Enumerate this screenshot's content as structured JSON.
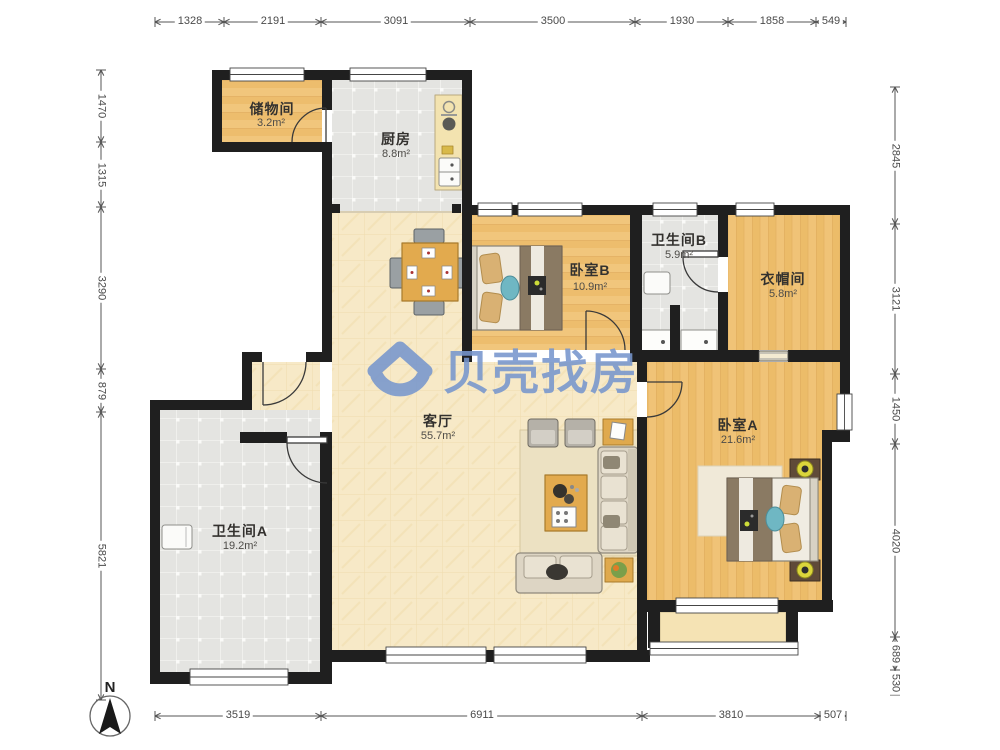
{
  "watermark": {
    "brand": "贝壳找房"
  },
  "compass": {
    "north": "N"
  },
  "rooms": {
    "storage": {
      "name": "储物间",
      "area": "3.2m²"
    },
    "kitchen": {
      "name": "厨房",
      "area": "8.8m²"
    },
    "bedroomB": {
      "name": "卧室B",
      "area": "10.9m²"
    },
    "bathroomB": {
      "name": "卫生间B",
      "area": "5.9m²"
    },
    "cloakroom": {
      "name": "衣帽间",
      "area": "5.8m²"
    },
    "living": {
      "name": "客厅",
      "area": "55.7m²"
    },
    "bedroomA": {
      "name": "卧室A",
      "area": "21.6m²"
    },
    "bathroomA": {
      "name": "卫生间A",
      "area": "19.2m²"
    }
  },
  "dimensions": {
    "top": [
      "1328",
      "2191",
      "3091",
      "3500",
      "1930",
      "1858",
      "549"
    ],
    "bottom": [
      "3519",
      "6911",
      "3810",
      "507"
    ],
    "left": [
      "1470",
      "1315",
      "3290",
      "879",
      "5821"
    ],
    "right": [
      "2845",
      "3121",
      "1450",
      "4020",
      "689",
      "530"
    ]
  },
  "colors": {
    "wall": "#1f1f1f",
    "wood_floor": "#f0c377",
    "tile_floor": "#e4e4e1",
    "living_floor": "#f7e9c7",
    "watermark_blue": "#7796cd"
  }
}
